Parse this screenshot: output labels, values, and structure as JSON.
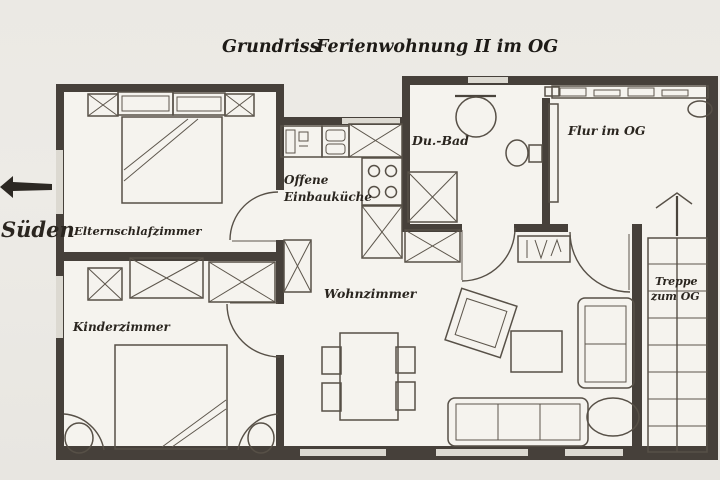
{
  "title": {
    "part1": "Grundriss",
    "part2": "Ferienwohnung II im OG"
  },
  "compass": {
    "label": "Süden"
  },
  "rooms": {
    "elternschlafzimmer": {
      "label": "Elternschlafzimmer"
    },
    "kinderzimmer": {
      "label": "Kinderzimmer"
    },
    "kueche": {
      "line1": "Offene",
      "line2": "Einbauküche"
    },
    "wohnzimmer": {
      "label": "Wohnzimmer"
    },
    "bad": {
      "label": "Du.-Bad"
    },
    "flur": {
      "label": "Flur im OG"
    },
    "treppe": {
      "line1": "Treppe",
      "line2": "zum OG"
    }
  },
  "colors": {
    "paper": "#ebe9e4",
    "interior": "#f5f3ee",
    "wall_ink": "#46403a",
    "line_ink": "#575047",
    "text_ink": "#2a251f"
  }
}
